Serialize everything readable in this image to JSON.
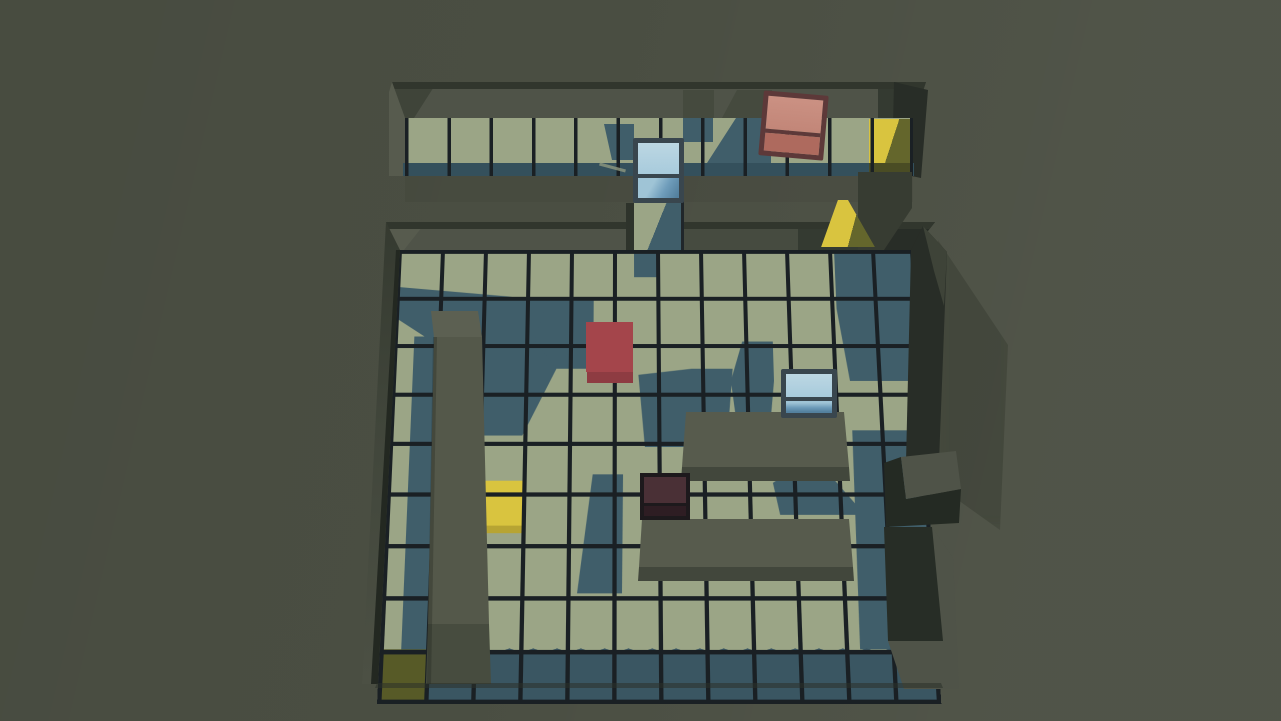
{
  "meta": {
    "app_type": "isometric-3d-block-puzzle-game",
    "view": "top-down tilted room view",
    "screenshot_size": "1281x721",
    "visible_text": []
  },
  "palette": {
    "bg": "#4a4e42",
    "tile_lit": "#9ba586",
    "tile_shadow": "#405e6a",
    "tile_dark_row": "#3a5662",
    "tile_front": "#34505c",
    "grid_line": "#1a2024",
    "wall_face": "#4f5348",
    "wall_face_md": "#464b40",
    "wall_face_dark": "#343a31",
    "wall_face_darkest": "#282d27",
    "wall_top_edge": "#31362d",
    "wall_corner_light": "#575b4e",
    "pillar_top": "#5c6052",
    "pillar_body": "#54584a",
    "pillar_front": "#474c3f",
    "platform_top": "#575b4d",
    "platform_front": "#42473c",
    "goal_lit": "#d9c43f",
    "goal_olive": "#64662c",
    "goal_dark": "#575a27",
    "goal_front": "#4a4c24",
    "red_top": "#a4454b",
    "red_front": "#8e3c42",
    "salmon_frame": "#5d3939",
    "salmon_top": "#c28678",
    "salmon_front": "#ae6a5e",
    "glass_frame": "#39464e",
    "glass_top": "#a8cbdc",
    "glass_front_hi": "#9fc4d6",
    "glass_front_md": "#6e9cba",
    "glass_front_lo": "#53809e",
    "dark_frame": "#1d191c",
    "dark_top": "#4a3036",
    "dark_front": "#2e1d23"
  },
  "scene": {
    "upper_platform": {
      "grid_size": {
        "cols": 12,
        "rows": 1
      },
      "blocks": [
        {
          "id": "glass-cube-upper",
          "kind": "glass framed cube",
          "color_name": "light-blue",
          "grid_col": 6,
          "note": "overhangs front edge above center bridge"
        },
        {
          "id": "salmon-cube",
          "kind": "framed cube",
          "color_name": "salmon-red",
          "grid_col": 10,
          "note": "slightly rotated clockwise"
        }
      ],
      "goal_tiles": [
        {
          "id": "goal-upper-right",
          "color_name": "yellow",
          "grid_col": 12,
          "state": "right half in wall shadow"
        }
      ],
      "bridges": [
        {
          "id": "bridge-center",
          "connects": "upper platform to main room",
          "at_col": 6,
          "state": "half shadowed"
        },
        {
          "id": "bridge-right-marker",
          "connects": "upper platform to main room",
          "at_col": 11,
          "state": "yellow, widening toward room"
        }
      ]
    },
    "main_room": {
      "grid_size": {
        "cols": 12,
        "rows": 9
      },
      "blocks": [
        {
          "id": "red-block",
          "kind": "solid block",
          "color_name": "red",
          "grid": {
            "col": 5,
            "row": 3
          }
        },
        {
          "id": "glass-cube-main",
          "kind": "glass framed cube",
          "color_name": "light-blue",
          "grid": {
            "col": 10,
            "row": 4
          }
        },
        {
          "id": "dark-cube",
          "kind": "framed cube",
          "color_name": "dark-maroon (in shadow)",
          "grid": {
            "col": 7,
            "row": 6
          }
        }
      ],
      "goal_tiles": [
        {
          "id": "goal-main-center",
          "color_name": "yellow",
          "grid": {
            "col": 3,
            "row": 6
          },
          "state": "lit"
        },
        {
          "id": "goal-main-bottom-left",
          "color_name": "yellow",
          "grid": {
            "col": 1,
            "row": 9
          },
          "state": "in shadow"
        }
      ],
      "walls": [
        {
          "id": "pillar-wall",
          "span": "col 2, rows 2-9",
          "kind": "tall interior wall"
        },
        {
          "id": "platform-upper",
          "span": "cols 7-10, row 4-5",
          "kind": "raised block"
        },
        {
          "id": "platform-lower",
          "span": "cols 7-11, row 6-7",
          "kind": "raised block"
        },
        {
          "id": "right-wall-block",
          "span": "right edge, rows 5-6",
          "kind": "wall stub jutting outward"
        }
      ],
      "lighting": "sun from upper right; teal shadows cast down-left; bottom row and right edge in shade"
    }
  }
}
